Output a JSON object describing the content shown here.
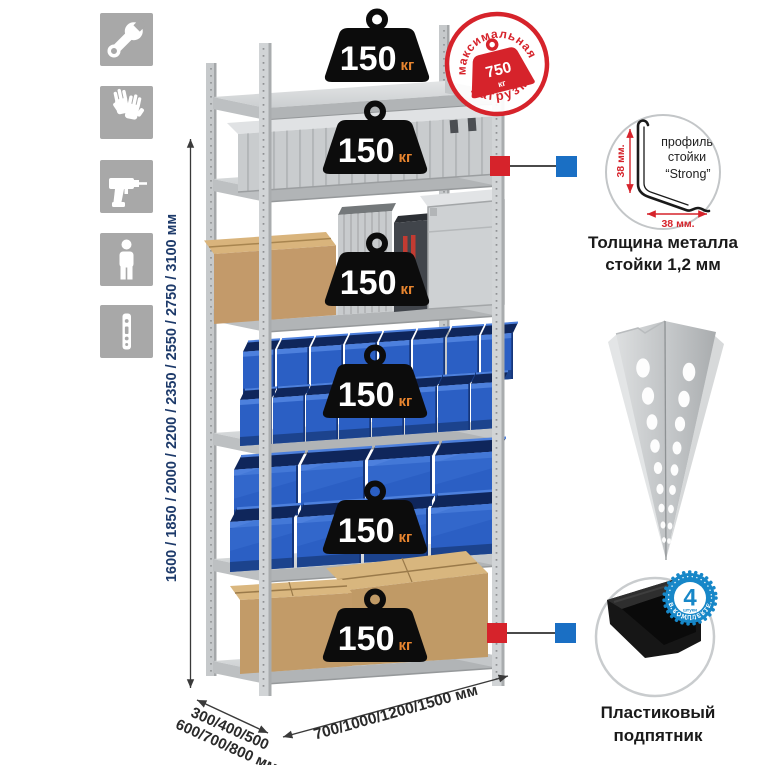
{
  "left_panel": {
    "icons": [
      {
        "name": "wrench-icon"
      },
      {
        "name": "gloves-icon"
      },
      {
        "name": "drill-icon"
      },
      {
        "name": "person-height-icon"
      },
      {
        "name": "upright-post-icon"
      }
    ]
  },
  "height_dimension": {
    "label": "1600 / 1850 / 2000 / 2200 / 2350 / 2550 / 2750 / 3100 мм"
  },
  "load_badges": [
    {
      "value": "150",
      "unit": "кг"
    },
    {
      "value": "150",
      "unit": "кг"
    },
    {
      "value": "150",
      "unit": "кг"
    },
    {
      "value": "150",
      "unit": "кг"
    },
    {
      "value": "150",
      "unit": "кг"
    },
    {
      "value": "150",
      "unit": "кг"
    }
  ],
  "max_load_stamp": {
    "arc_top": "максимальная",
    "arc_bottom": "нагрузка",
    "value": "750",
    "unit": "кг"
  },
  "post_profile_detail": {
    "vertical_dim": "38 мм.",
    "horizontal_dim": "38 мм.",
    "label_line1": "профиль",
    "label_line2": "стойки",
    "label_line3": "“Strong”",
    "caption_line1": "Толщина металла",
    "caption_line2": "стойки 1,2 мм"
  },
  "plastic_foot_detail": {
    "badge_count": "4",
    "badge_small_text": "штуки",
    "badge_arc_text": "В КОМПЛЕКТЕ",
    "caption_line1": "Пластиковый",
    "caption_line2": "подпятник"
  },
  "base_dimensions": {
    "depth_line1": "300/400/500",
    "depth_line2": "600/700/800 мм",
    "width": "700/1000/1200/1500 мм"
  },
  "colors": {
    "stamp_red": "#d6232b",
    "callout_red": "#d6232b",
    "callout_blue": "#1a6fc4",
    "badge_blue": "#1787c8",
    "kg_orange": "#e8852f",
    "height_label_navy": "#1d3a6a",
    "bin_blue": "#2b5fc4",
    "icon_gray": "#a8a8a8"
  }
}
